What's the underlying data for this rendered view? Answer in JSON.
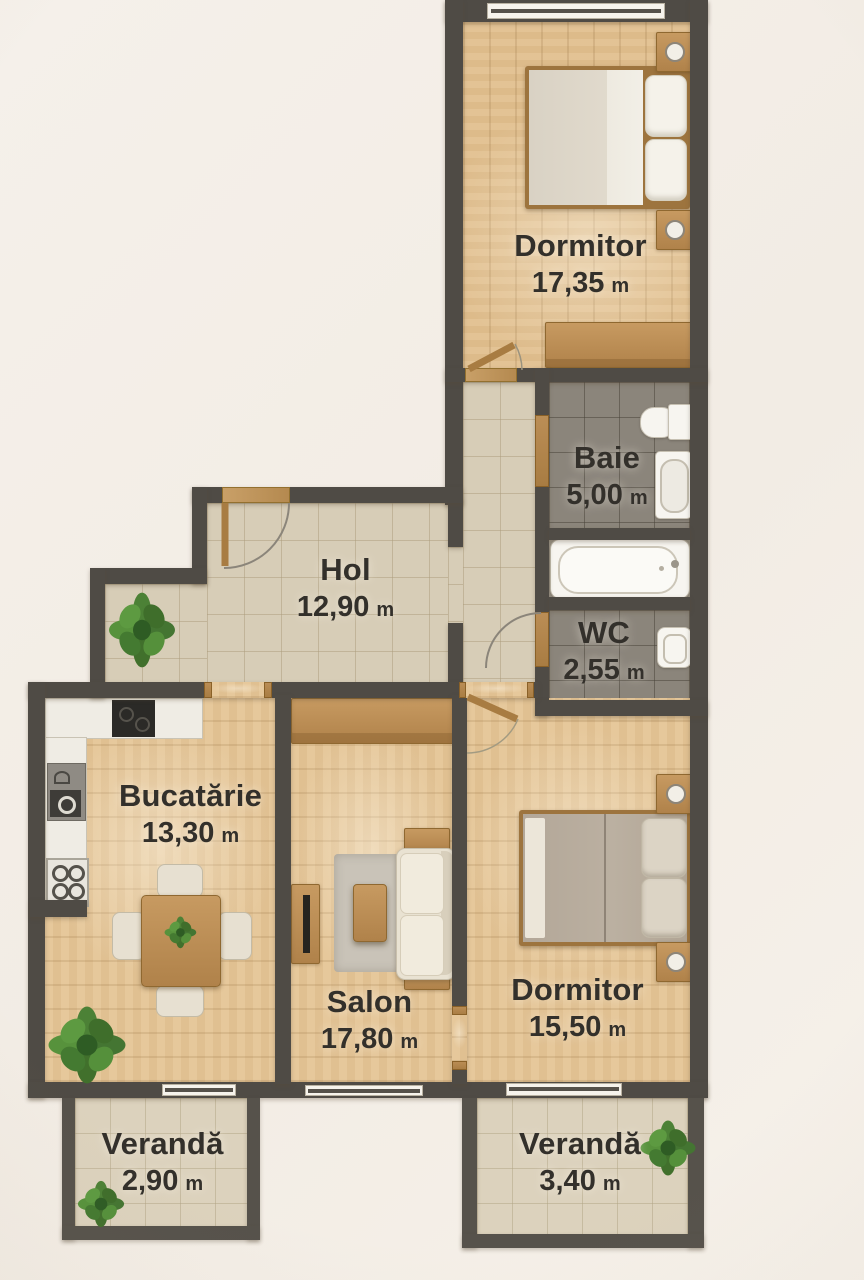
{
  "plan": {
    "unit": "m",
    "rooms": [
      {
        "id": "dormitor-1",
        "name": "Dormitor",
        "area": "17,35"
      },
      {
        "id": "baie",
        "name": "Baie",
        "area": "5,00"
      },
      {
        "id": "hol",
        "name": "Hol",
        "area": "12,90"
      },
      {
        "id": "wc",
        "name": "WC",
        "area": "2,55"
      },
      {
        "id": "bucatarie",
        "name": "Bucatărie",
        "area": "13,30"
      },
      {
        "id": "salon",
        "name": "Salon",
        "area": "17,80"
      },
      {
        "id": "dormitor-2",
        "name": "Dormitor",
        "area": "15,50"
      },
      {
        "id": "veranda-stanga",
        "name": "Verandă",
        "area": "2,90"
      },
      {
        "id": "veranda-dreapta",
        "name": "Verandă",
        "area": "3,40"
      }
    ],
    "colors": {
      "wall": "#4f4b45",
      "exterior": "#f3eee7",
      "wood_floor": "#e3c191",
      "hol_tile": "#d7cdb7",
      "bath_tile": "#8b857b",
      "veranda_tile": "#dcd2bd",
      "door_wood": "#ab8049",
      "fixture_white": "#f7f5f0",
      "plant_green": "#4c8136",
      "label_text": "#33302b"
    }
  }
}
